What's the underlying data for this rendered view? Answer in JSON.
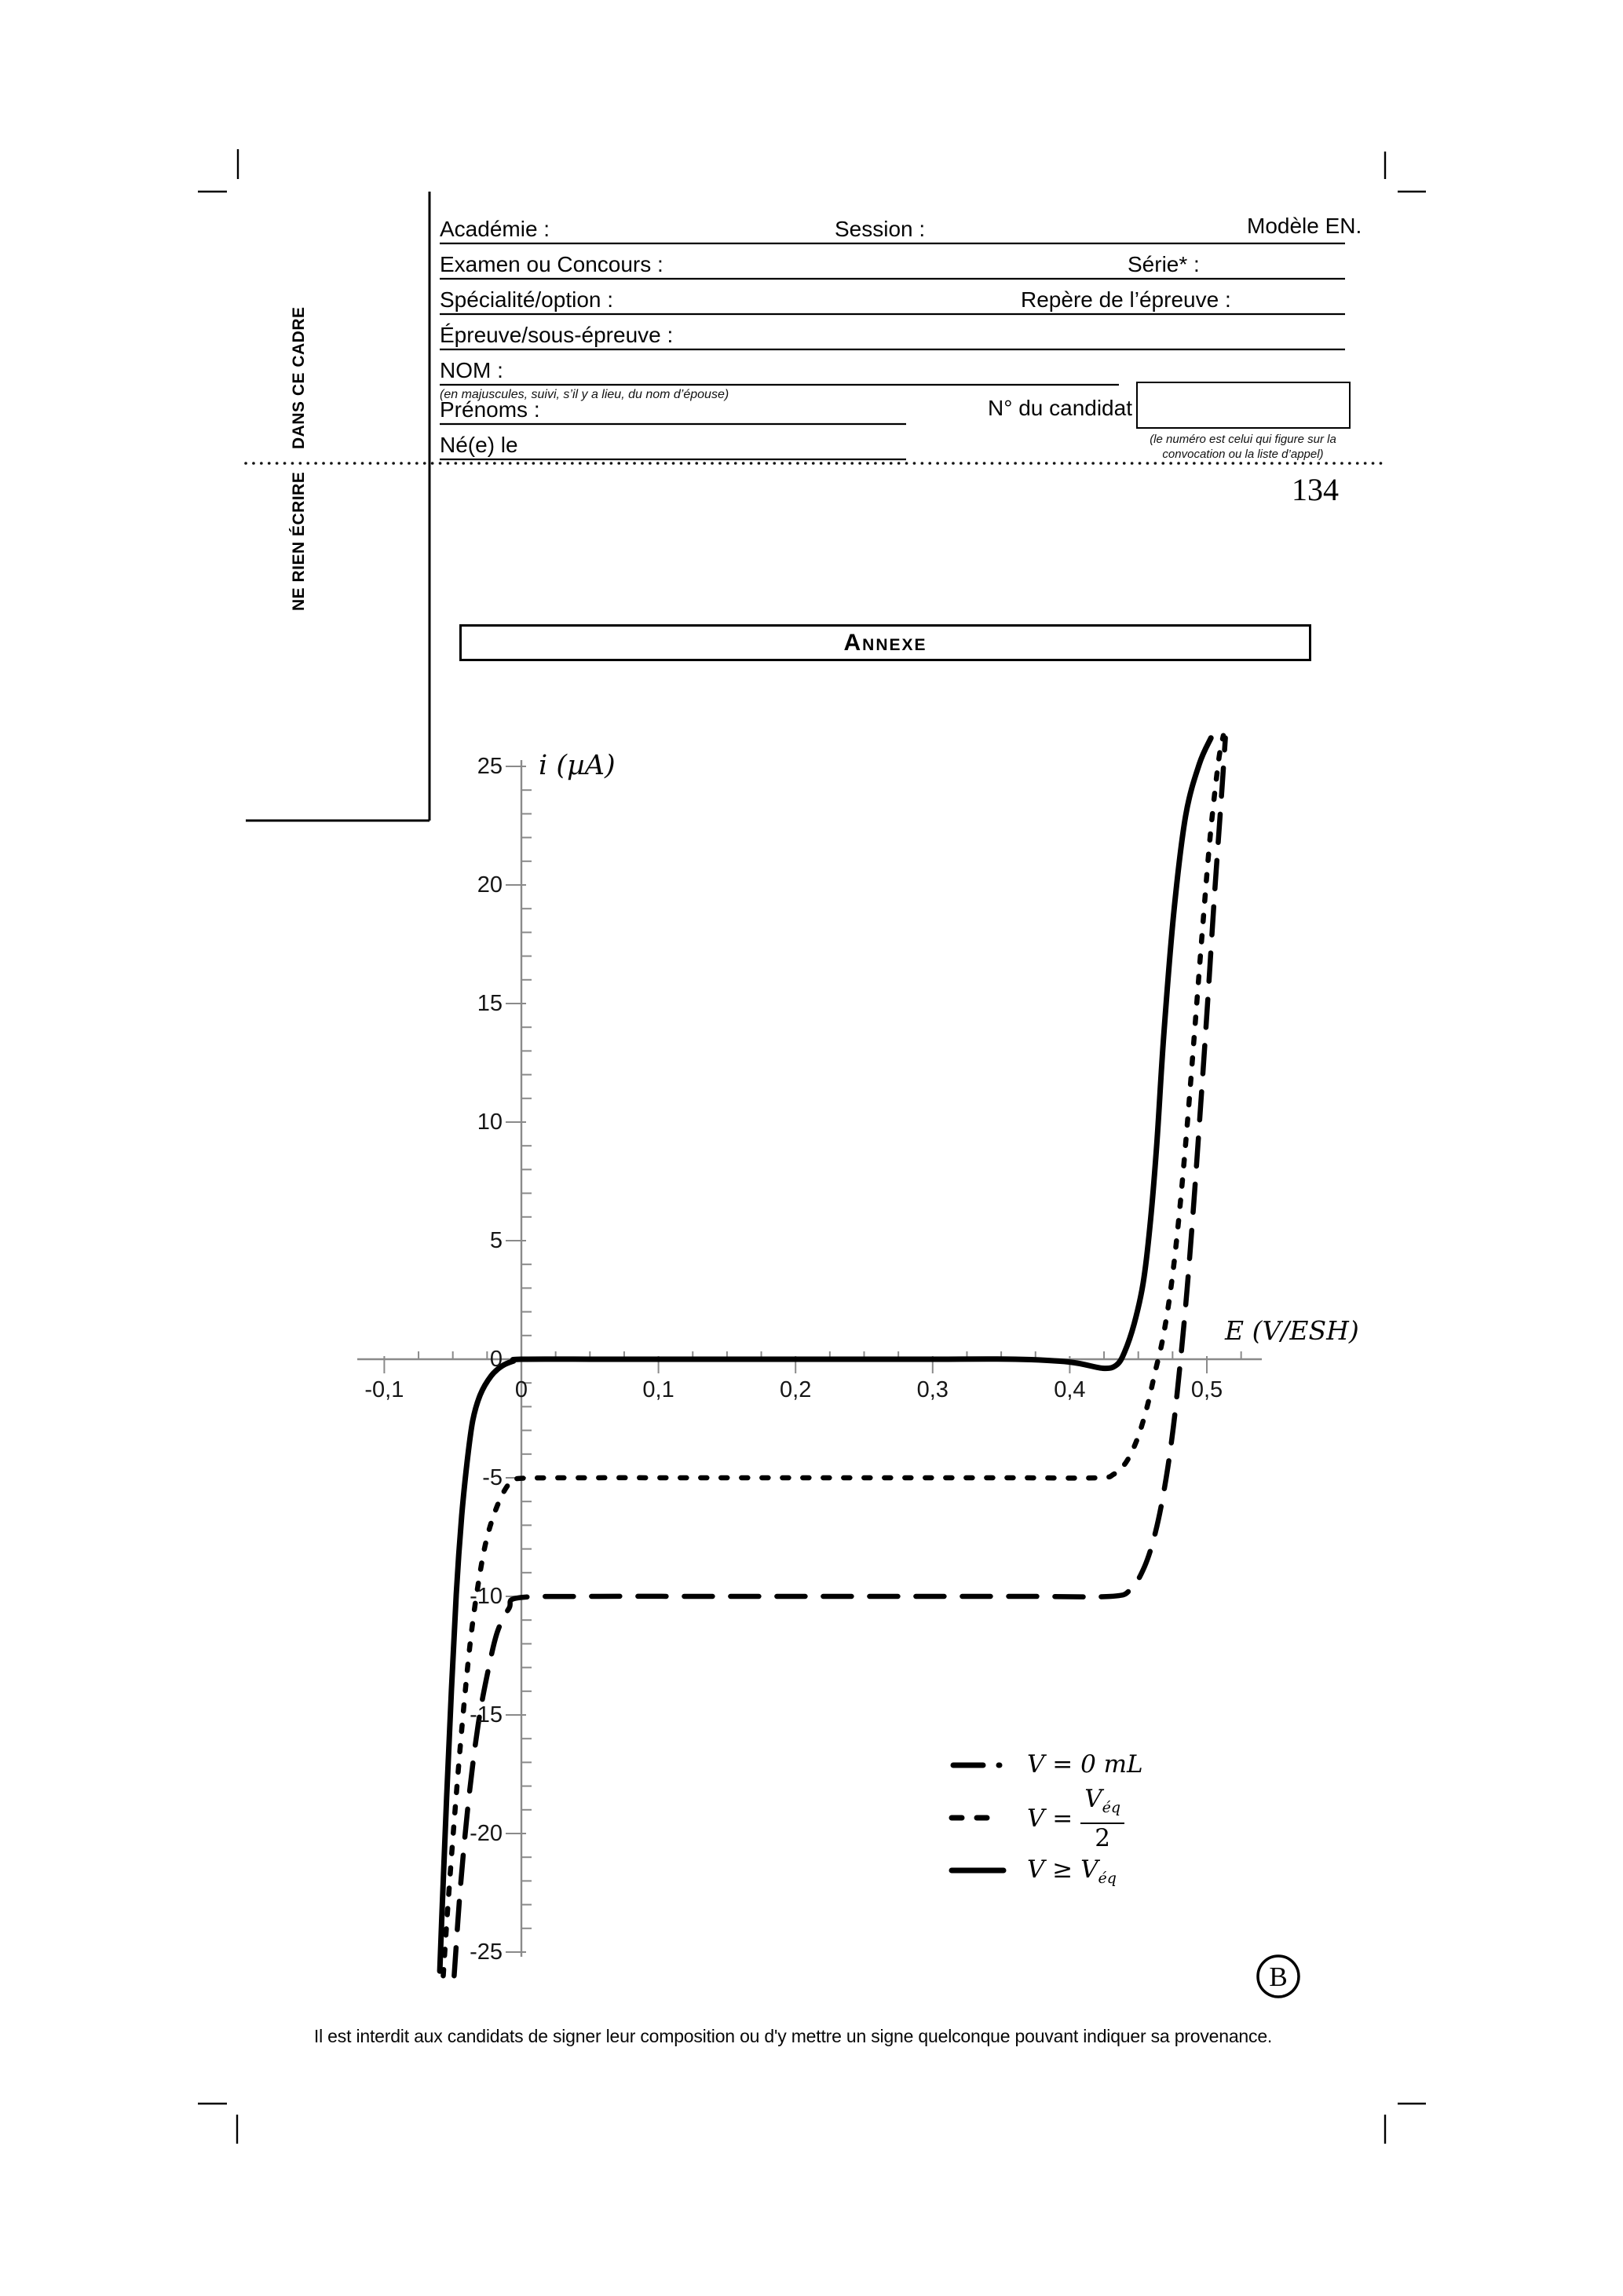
{
  "page": {
    "number": "134",
    "corner_letter": "B",
    "footer": "Il est interdit aux candidats de signer leur composition ou d'y mettre un signe quelconque pouvant indiquer sa provenance."
  },
  "margin_zone": {
    "line_top": "DANS CE CADRE",
    "line_bottom": "NE RIEN ÉCRIRE"
  },
  "form": {
    "academie": "Académie :",
    "session": "Session :",
    "modele": "Modèle EN.",
    "examen": "Examen ou Concours :",
    "serie": "Série* :",
    "specialite": "Spécialité/option :",
    "repere": "Repère de l’épreuve :",
    "epreuve": "Épreuve/sous-épreuve :",
    "nom": "NOM :",
    "nom_note": "(en majuscules, suivi, s’il y a lieu, du nom d’épouse)",
    "prenoms": "Prénoms :",
    "candidat": "N° du candidat",
    "candidat_note1": "(le numéro est celui qui figure sur la",
    "candidat_note2": "convocation ou la liste d’appel)",
    "ne_le": "Né(e) le"
  },
  "annexe_title": "Annexe",
  "legend": {
    "item1_label": "V = 0 mL",
    "item2_prefix": "V =",
    "item2_frac_num": "V",
    "item2_frac_num_sub": "éq",
    "item2_frac_den": "2",
    "item3_main": "V ≥ V",
    "item3_sub": "éq"
  },
  "chart_data": {
    "type": "line",
    "title": "",
    "xlabel": "E (V/ESH)",
    "ylabel": "i (µA)",
    "xlim": [
      -0.12,
      0.54
    ],
    "ylim": [
      -26,
      26
    ],
    "grid": false,
    "legend_position": "lower right",
    "x_major_ticks": [
      -0.1,
      0,
      0.1,
      0.2,
      0.3,
      0.4,
      0.5
    ],
    "x_tick_labels": [
      "-0,1",
      "0",
      "0,1",
      "0,2",
      "0,3",
      "0,4",
      "0,5"
    ],
    "x_minor_step": 0.025,
    "y_major_ticks": [
      25,
      20,
      15,
      10,
      5,
      0,
      -5,
      -10,
      -15,
      -20,
      -25
    ],
    "y_tick_labels": [
      "25",
      "20",
      "15",
      "10",
      "5",
      "0",
      "-5",
      "-10",
      "-15",
      "-20",
      "-25"
    ],
    "y_minor_step": 1,
    "series": [
      {
        "name": "V = 0 mL",
        "style": "dash-dot",
        "points": [
          [
            -0.049,
            -26
          ],
          [
            -0.0445,
            -22.3
          ],
          [
            -0.0385,
            -18.6
          ],
          [
            -0.0315,
            -15.4
          ],
          [
            -0.0245,
            -13.2
          ],
          [
            -0.0175,
            -11.5
          ],
          [
            -0.009,
            -10.5
          ],
          [
            -0.002,
            -10.06
          ],
          [
            0.05,
            -10
          ],
          [
            0.13,
            -10
          ],
          [
            0.21,
            -10
          ],
          [
            0.29,
            -10
          ],
          [
            0.37,
            -10
          ],
          [
            0.43,
            -10
          ],
          [
            0.4445,
            -9.7
          ],
          [
            0.4545,
            -8.75
          ],
          [
            0.4625,
            -7.3
          ],
          [
            0.4695,
            -5.3
          ],
          [
            0.4755,
            -2.9
          ],
          [
            0.4805,
            -0.2
          ],
          [
            0.4855,
            2.9
          ],
          [
            0.4905,
            6.6
          ],
          [
            0.4955,
            10.7
          ],
          [
            0.5005,
            15
          ],
          [
            0.5055,
            19.5
          ],
          [
            0.5105,
            23.6
          ],
          [
            0.5135,
            26.2
          ]
        ]
      },
      {
        "name": "V = Véq/2",
        "style": "dashed",
        "points": [
          [
            -0.057,
            -26
          ],
          [
            -0.054,
            -23.4
          ],
          [
            -0.049,
            -19.5
          ],
          [
            -0.043,
            -15.3
          ],
          [
            -0.037,
            -11.8
          ],
          [
            -0.031,
            -9.3
          ],
          [
            -0.025,
            -7.5
          ],
          [
            -0.017,
            -6.1
          ],
          [
            -0.009,
            -5.25
          ],
          [
            -0.002,
            -5.03
          ],
          [
            0.05,
            -5
          ],
          [
            0.12,
            -5
          ],
          [
            0.2,
            -5
          ],
          [
            0.28,
            -5
          ],
          [
            0.36,
            -5
          ],
          [
            0.42,
            -5
          ],
          [
            0.432,
            -4.85
          ],
          [
            0.441,
            -4.35
          ],
          [
            0.449,
            -3.4
          ],
          [
            0.456,
            -2.1
          ],
          [
            0.462,
            -0.6
          ],
          [
            0.468,
            0.9
          ],
          [
            0.474,
            3.1
          ],
          [
            0.4795,
            5.9
          ],
          [
            0.485,
            9.4
          ],
          [
            0.4905,
            13.4
          ],
          [
            0.4965,
            17.9
          ],
          [
            0.5025,
            22.1
          ],
          [
            0.5085,
            25.2
          ],
          [
            0.512,
            26.3
          ]
        ]
      },
      {
        "name": "V ≥ Véq",
        "style": "solid",
        "points": [
          [
            -0.0595,
            -25.8
          ],
          [
            -0.058,
            -23.5
          ],
          [
            -0.0545,
            -18.5
          ],
          [
            -0.051,
            -13.9
          ],
          [
            -0.0475,
            -9.9
          ],
          [
            -0.0435,
            -6.6
          ],
          [
            -0.0395,
            -4.3
          ],
          [
            -0.0355,
            -2.6
          ],
          [
            -0.03,
            -1.5
          ],
          [
            -0.022,
            -0.7
          ],
          [
            -0.014,
            -0.28
          ],
          [
            -0.006,
            -0.08
          ],
          [
            0,
            0
          ],
          [
            0.06,
            0
          ],
          [
            0.12,
            0
          ],
          [
            0.18,
            0
          ],
          [
            0.24,
            0
          ],
          [
            0.3,
            0
          ],
          [
            0.36,
            0
          ],
          [
            0.4,
            -0.12
          ],
          [
            0.424,
            -0.38
          ],
          [
            0.434,
            -0.25
          ],
          [
            0.44,
            0.3
          ],
          [
            0.447,
            1.5
          ],
          [
            0.4535,
            3.2
          ],
          [
            0.4585,
            5.6
          ],
          [
            0.4635,
            9.1
          ],
          [
            0.4685,
            13.6
          ],
          [
            0.476,
            18.9
          ],
          [
            0.4845,
            22.9
          ],
          [
            0.4945,
            25.1
          ],
          [
            0.503,
            26.2
          ]
        ]
      }
    ]
  }
}
